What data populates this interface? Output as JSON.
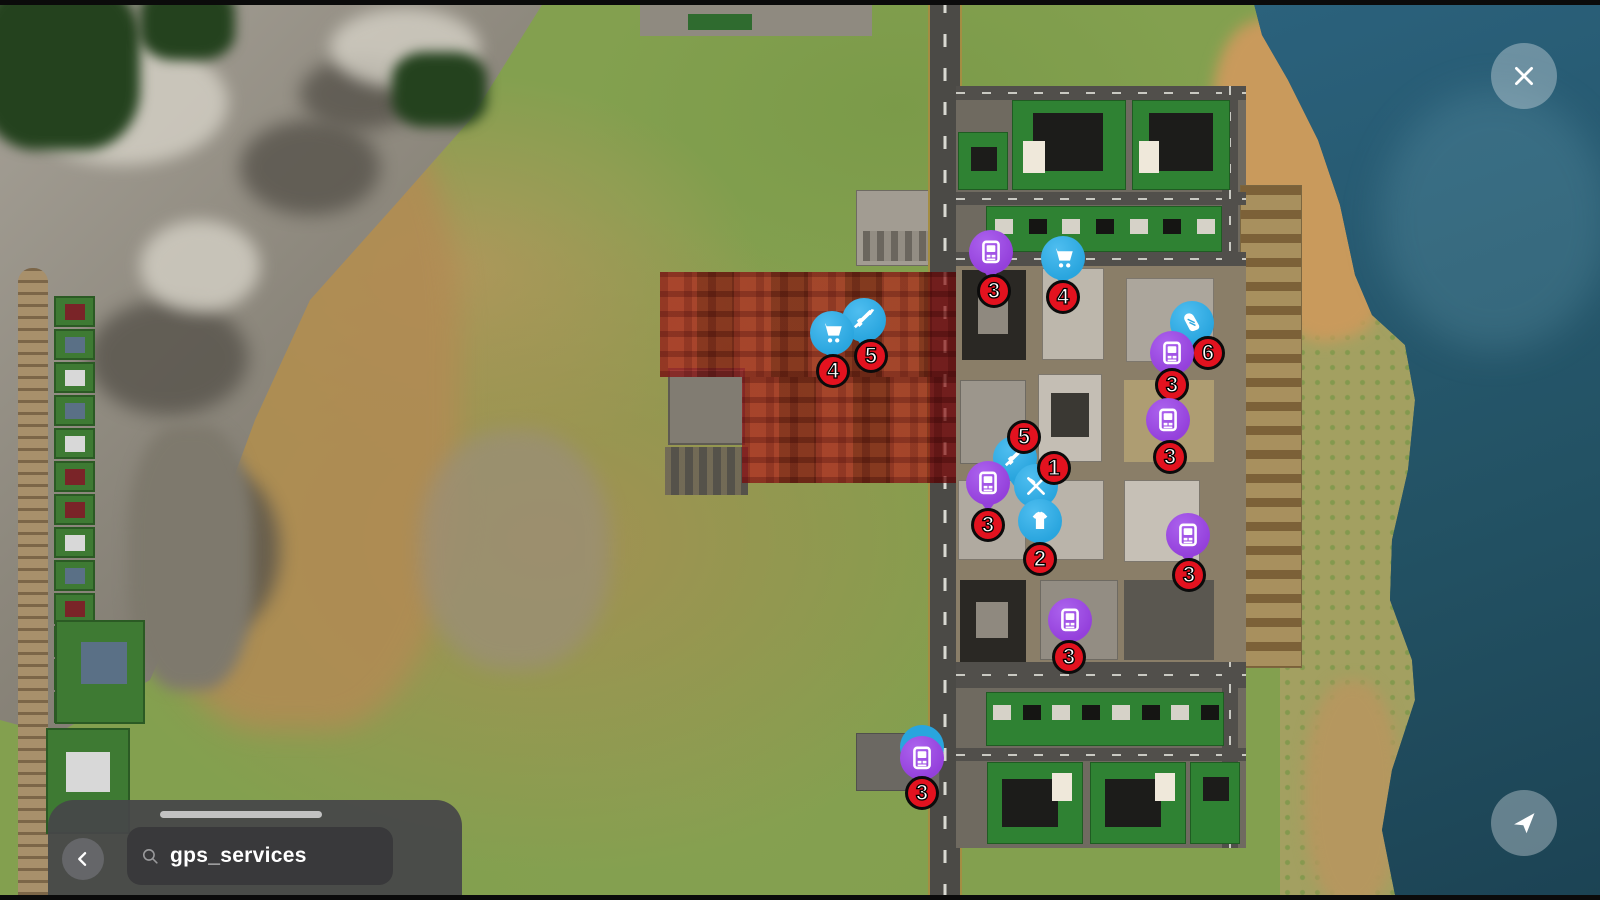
{
  "overlay": {
    "close_button": {
      "icon": "close-icon"
    },
    "locate_button": {
      "icon": "navigation-arrow-icon"
    },
    "search_panel": {
      "back_icon": "chevron-left-icon",
      "search_icon": "search-icon",
      "search_value": "gps_services"
    }
  },
  "map": {
    "restricted_zone": {
      "label": "restricted-zone-overlay",
      "color": "#B00E0E"
    },
    "marker_colors": {
      "purple": "#9440DB",
      "blue": "#29A5DE",
      "badge_red": "#E3121F",
      "badge_text": "#FFFFFF"
    },
    "markers": [
      {
        "category": "gun-shop",
        "icon": "rifle-icon",
        "color": "blue",
        "count": "5",
        "x": 864,
        "y": 320,
        "bdx": 7,
        "bdy": 36
      },
      {
        "category": "market",
        "icon": "cart-icon",
        "color": "blue",
        "count": "4",
        "x": 832,
        "y": 333,
        "bdx": 1,
        "bdy": 38
      },
      {
        "category": "atm",
        "icon": "atm-icon",
        "color": "purple",
        "count": "3",
        "x": 991,
        "y": 252,
        "bdx": 3,
        "bdy": 39
      },
      {
        "category": "market",
        "icon": "cart-icon",
        "color": "blue",
        "count": "4",
        "x": 1063,
        "y": 258,
        "bdx": 0,
        "bdy": 39
      },
      {
        "category": "shoe-shop",
        "icon": "sneaker-icon",
        "color": "blue",
        "count": "6",
        "x": 1192,
        "y": 323,
        "bdx": 16,
        "bdy": 30
      },
      {
        "category": "atm",
        "icon": "atm-icon",
        "color": "purple",
        "count": "3",
        "x": 1172,
        "y": 353,
        "bdx": 0,
        "bdy": 32
      },
      {
        "category": "atm",
        "icon": "atm-icon",
        "color": "purple",
        "count": "3",
        "x": 1168,
        "y": 420,
        "bdx": 2,
        "bdy": 37
      },
      {
        "category": "gun-shop",
        "icon": "rifle-icon",
        "color": "blue",
        "count": "5",
        "x": 1015,
        "y": 458,
        "bdx": 9,
        "bdy": -21
      },
      {
        "category": "atm",
        "icon": "atm-icon",
        "color": "purple",
        "count": "3",
        "x": 988,
        "y": 483,
        "bdx": 0,
        "bdy": 42
      },
      {
        "category": "melee-shop",
        "icon": "crossed-knives-icon",
        "color": "blue",
        "count": "1",
        "x": 1036,
        "y": 486,
        "bdx": 18,
        "bdy": -18
      },
      {
        "category": "clothes-shop",
        "icon": "tshirt-icon",
        "color": "blue",
        "count": "2",
        "x": 1040,
        "y": 521,
        "bdx": 0,
        "bdy": 38
      },
      {
        "category": "atm",
        "icon": "atm-icon",
        "color": "purple",
        "count": "3",
        "x": 1188,
        "y": 535,
        "bdx": 1,
        "bdy": 40
      },
      {
        "category": "atm",
        "icon": "atm-icon",
        "color": "purple",
        "count": "3",
        "x": 1070,
        "y": 620,
        "bdx": -1,
        "bdy": 37
      },
      {
        "category": "atm",
        "icon": "atm-icon",
        "color": "purple",
        "count": "3",
        "x": 922,
        "y": 758,
        "bdx": 0,
        "bdy": 35,
        "ghost": "blue"
      }
    ]
  }
}
